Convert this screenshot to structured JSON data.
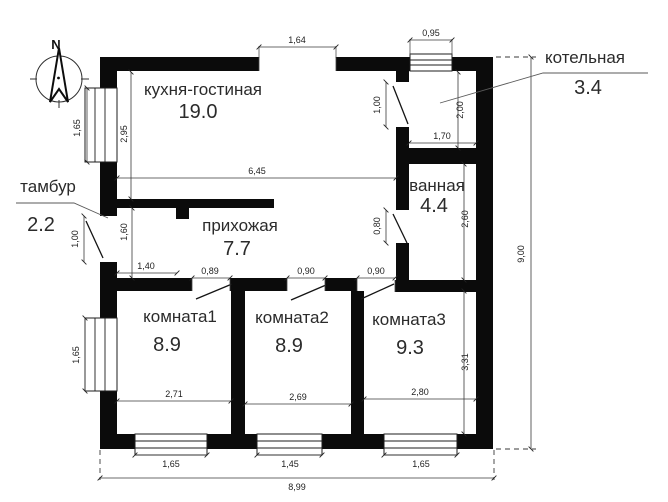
{
  "plan": {
    "compass": "N",
    "rooms": [
      {
        "name": "кухня-гостиная",
        "area": "19.0"
      },
      {
        "name": "тамбур",
        "area": "2.2"
      },
      {
        "name": "прихожая",
        "area": "7.7"
      },
      {
        "name": "котельная",
        "area": "3.4"
      },
      {
        "name": "ванная",
        "area": "4.4"
      },
      {
        "name": "комната1",
        "area": "8.9"
      },
      {
        "name": "комната2",
        "area": "8.9"
      },
      {
        "name": "комната3",
        "area": "9.3"
      }
    ],
    "dims": {
      "top_opening": "1,64",
      "top_window": "0,95",
      "left_window_top": "1,65",
      "kitchen_depth": "2,95",
      "kitchen_width": "6,45",
      "boiler_door": "1,00",
      "boiler_depth": "2,00",
      "boiler_width": "1,70",
      "bath_depth": "2,60",
      "bath_door": "0,80",
      "tambour_door": "1,00",
      "tambour_depth": "1,60",
      "tambour_width": "1,40",
      "room1_door": "0,89",
      "room2_door": "0,90",
      "room3_door": "0,90",
      "room1_width": "2,71",
      "room2_width": "2,69",
      "room3_width": "2,80",
      "room3_depth": "3,31",
      "left_window_bottom": "1,65",
      "window1": "1,65",
      "window2": "1,45",
      "window3": "1,65",
      "total_width": "8,99",
      "total_height": "9,00"
    }
  }
}
